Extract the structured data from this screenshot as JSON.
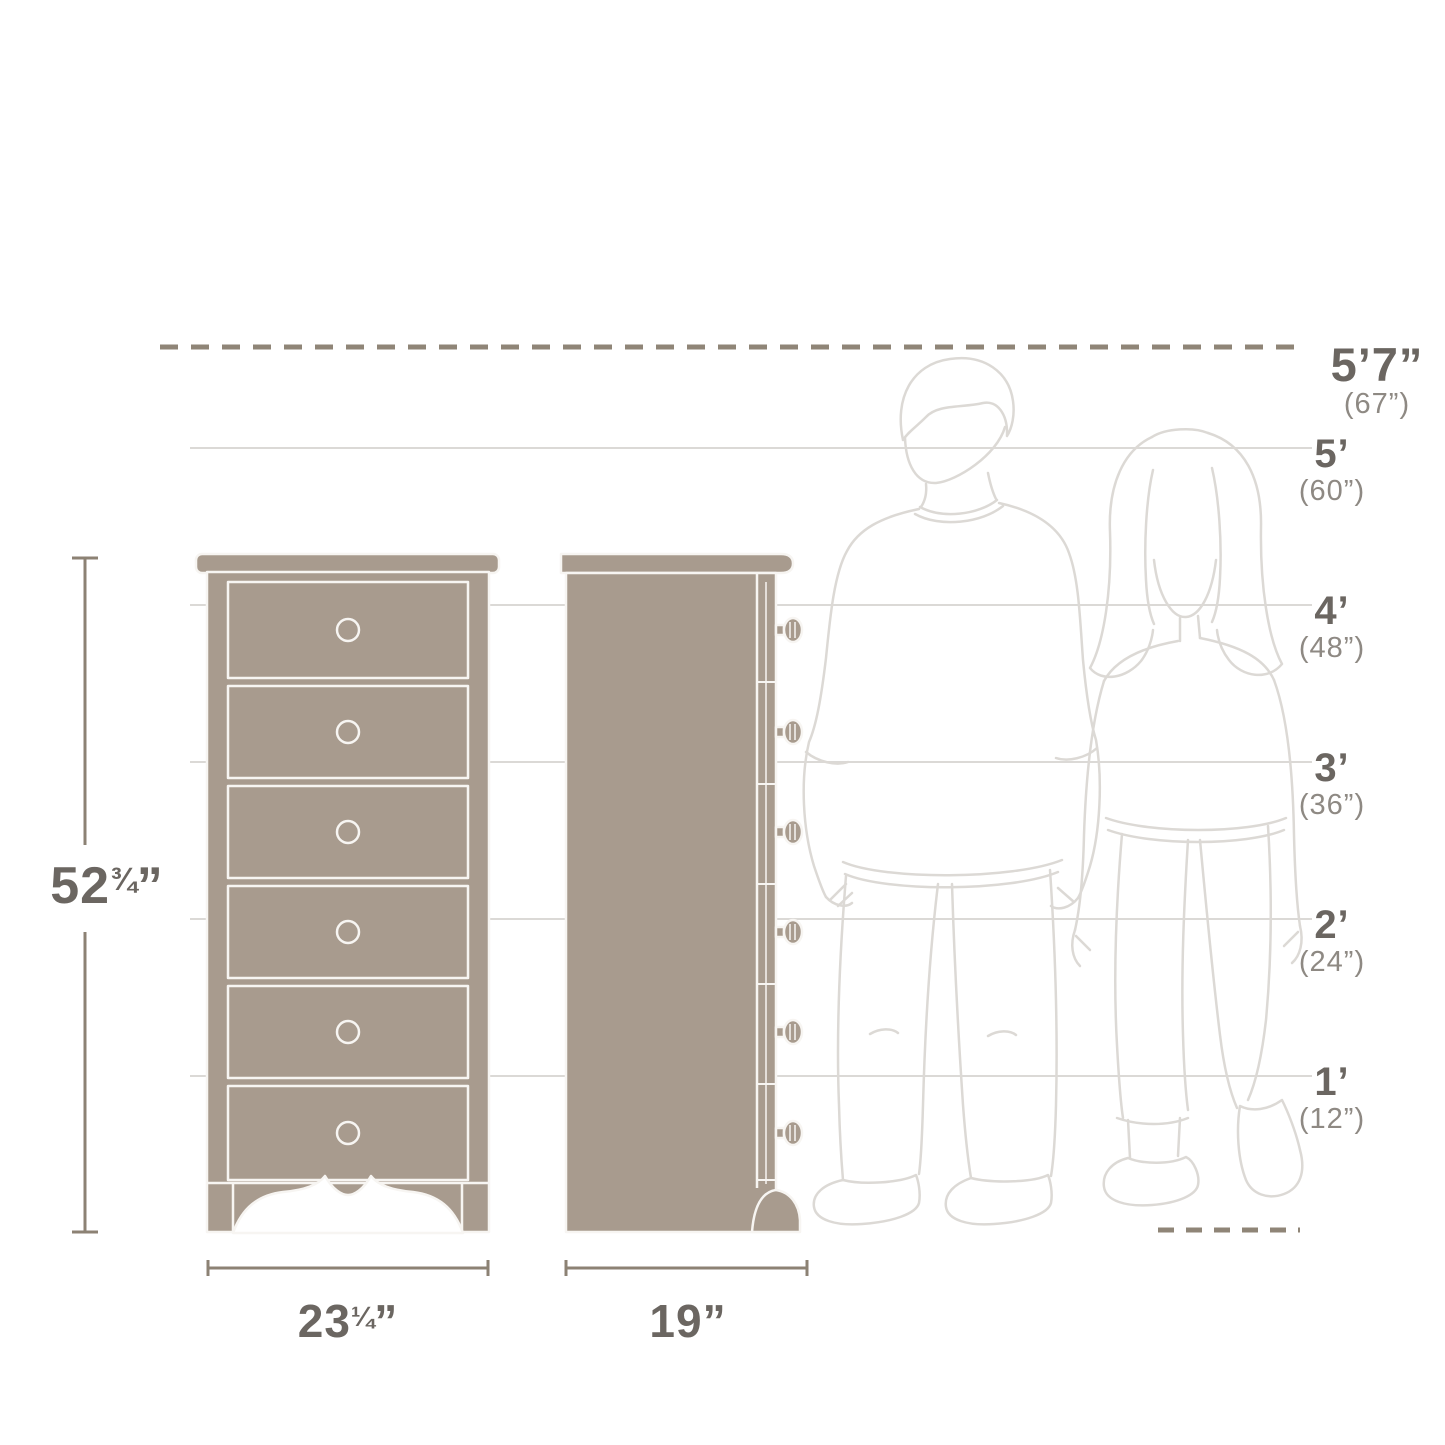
{
  "height_scale": {
    "ceiling": {
      "label": "5’7”",
      "sub": "(67”)"
    },
    "ticks": [
      {
        "label": "5’",
        "sub": "(60”)"
      },
      {
        "label": "4’",
        "sub": "(48”)"
      },
      {
        "label": "3’",
        "sub": "(36”)"
      },
      {
        "label": "2’",
        "sub": "(24”)"
      },
      {
        "label": "1’",
        "sub": "(12”)"
      }
    ]
  },
  "product_dimensions": {
    "height": {
      "main": "52",
      "fraction": "¾",
      "unit": "”"
    },
    "width": {
      "main": "23",
      "fraction": "¼",
      "unit": "”"
    },
    "depth": {
      "main": "19",
      "fraction": "",
      "unit": "”"
    }
  },
  "drawer_count": 6,
  "colors": {
    "furniture_fill": "#a89b8e",
    "furniture_outline": "#f7f5f2",
    "label_primary": "#6b6661",
    "label_secondary": "#8e8983",
    "dimension_line": "#8c8274",
    "dashed_marker_line": "#8f8577",
    "gridline": "#dbd9d6",
    "figure_line": "#dcd9d5"
  }
}
